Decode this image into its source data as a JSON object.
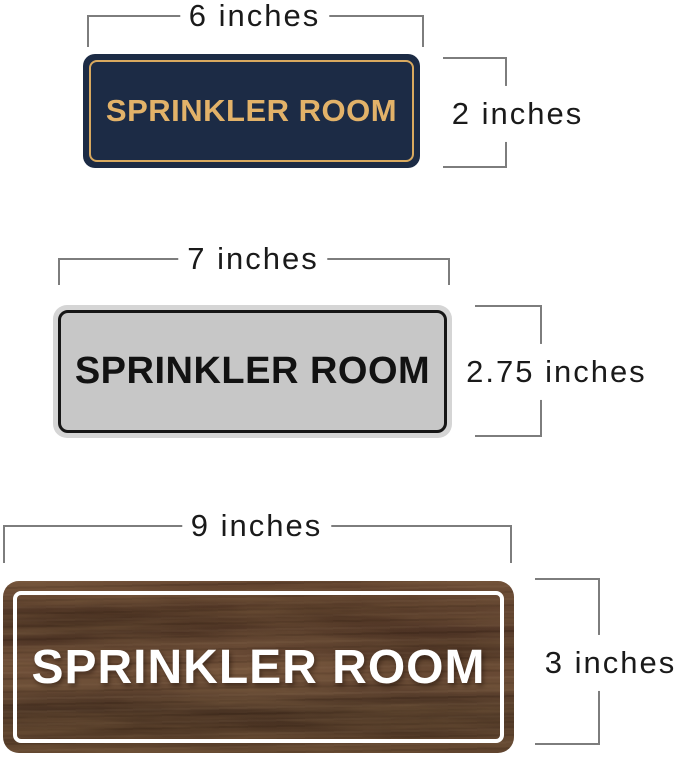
{
  "signs": [
    {
      "name": "navy-gold-sign",
      "label": "SPRINKLER ROOM",
      "width_label": "6 inches",
      "height_label": "2 inches",
      "colors": {
        "background": "#1c2b45",
        "border": "#d8a95f",
        "text": "#e2b269"
      }
    },
    {
      "name": "silver-black-sign",
      "label": "SPRINKLER ROOM",
      "width_label": "7 inches",
      "height_label": "2.75 inches",
      "colors": {
        "background": "#c7c7c7",
        "rim": "#d5d5d5",
        "border": "#161616",
        "text": "#121212"
      }
    },
    {
      "name": "walnut-white-sign",
      "label": "SPRINKLER ROOM",
      "width_label": "9 inches",
      "height_label": "3 inches",
      "colors": {
        "background": "#5a4030",
        "border": "#ffffff",
        "text": "#ffffff"
      }
    }
  ],
  "dimension_style": {
    "line_color": "#7d7d7d",
    "text_color": "#1a1a1a"
  }
}
